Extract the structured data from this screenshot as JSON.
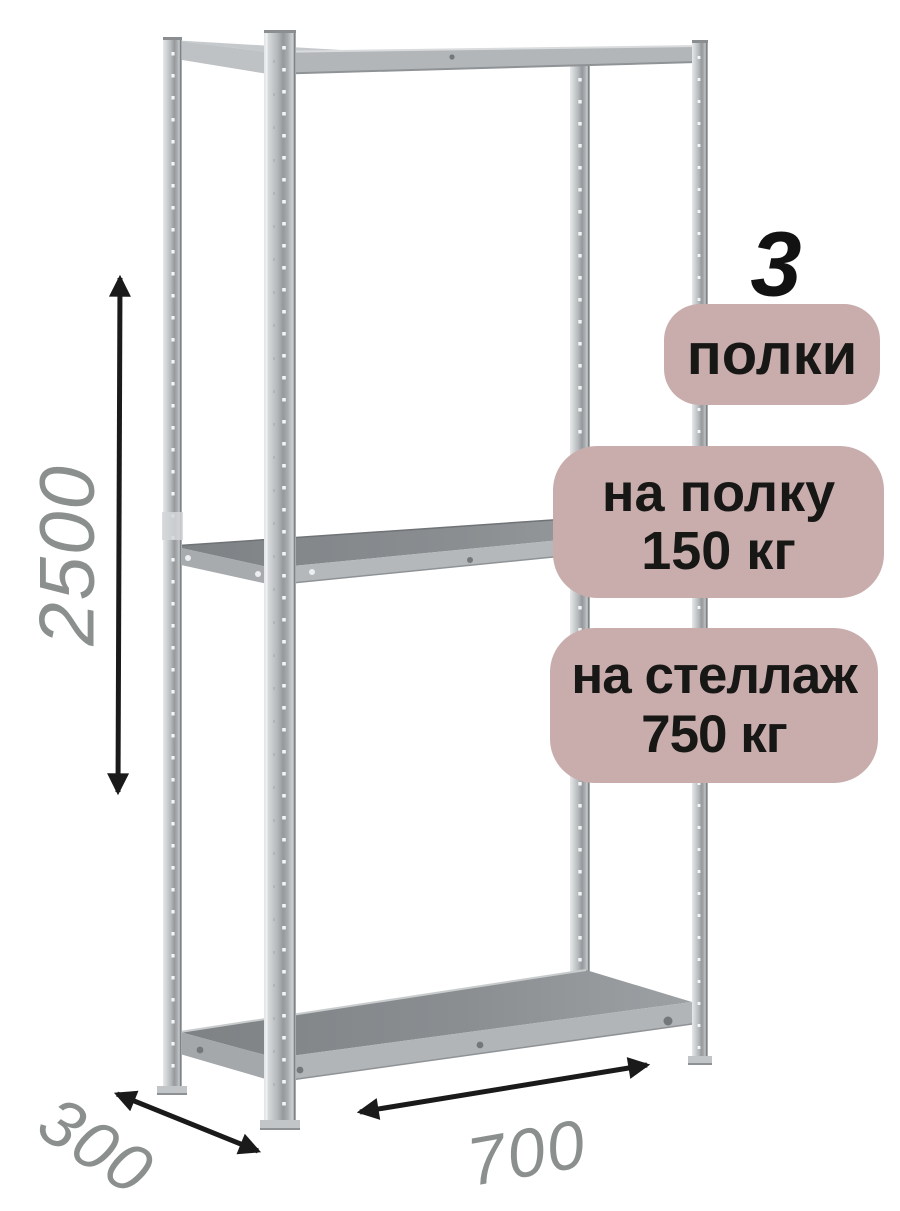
{
  "diagram": {
    "dimensions": {
      "height": "2500",
      "depth": "300",
      "width": "700"
    },
    "badges": {
      "shelf_count_number": "3",
      "shelf_count_label": "полки",
      "per_shelf_line1": "на полку",
      "per_shelf_line2": "150 кг",
      "per_rack_line1": "на стеллаж",
      "per_rack_line2": "750 кг"
    },
    "colors": {
      "background": "#ffffff",
      "badge_bg": "#c9adad",
      "badge_text": "#171715",
      "count_text": "#121212",
      "dimension_text": "#8b908f",
      "arrow": "#1a1a1a",
      "metal_light": "#e6e8ea",
      "metal_mid": "#b4b8ba",
      "metal_dark": "#95999c",
      "shelf_surface_dark": "#84888b",
      "shelf_edge_light": "#b1b5b8"
    }
  }
}
